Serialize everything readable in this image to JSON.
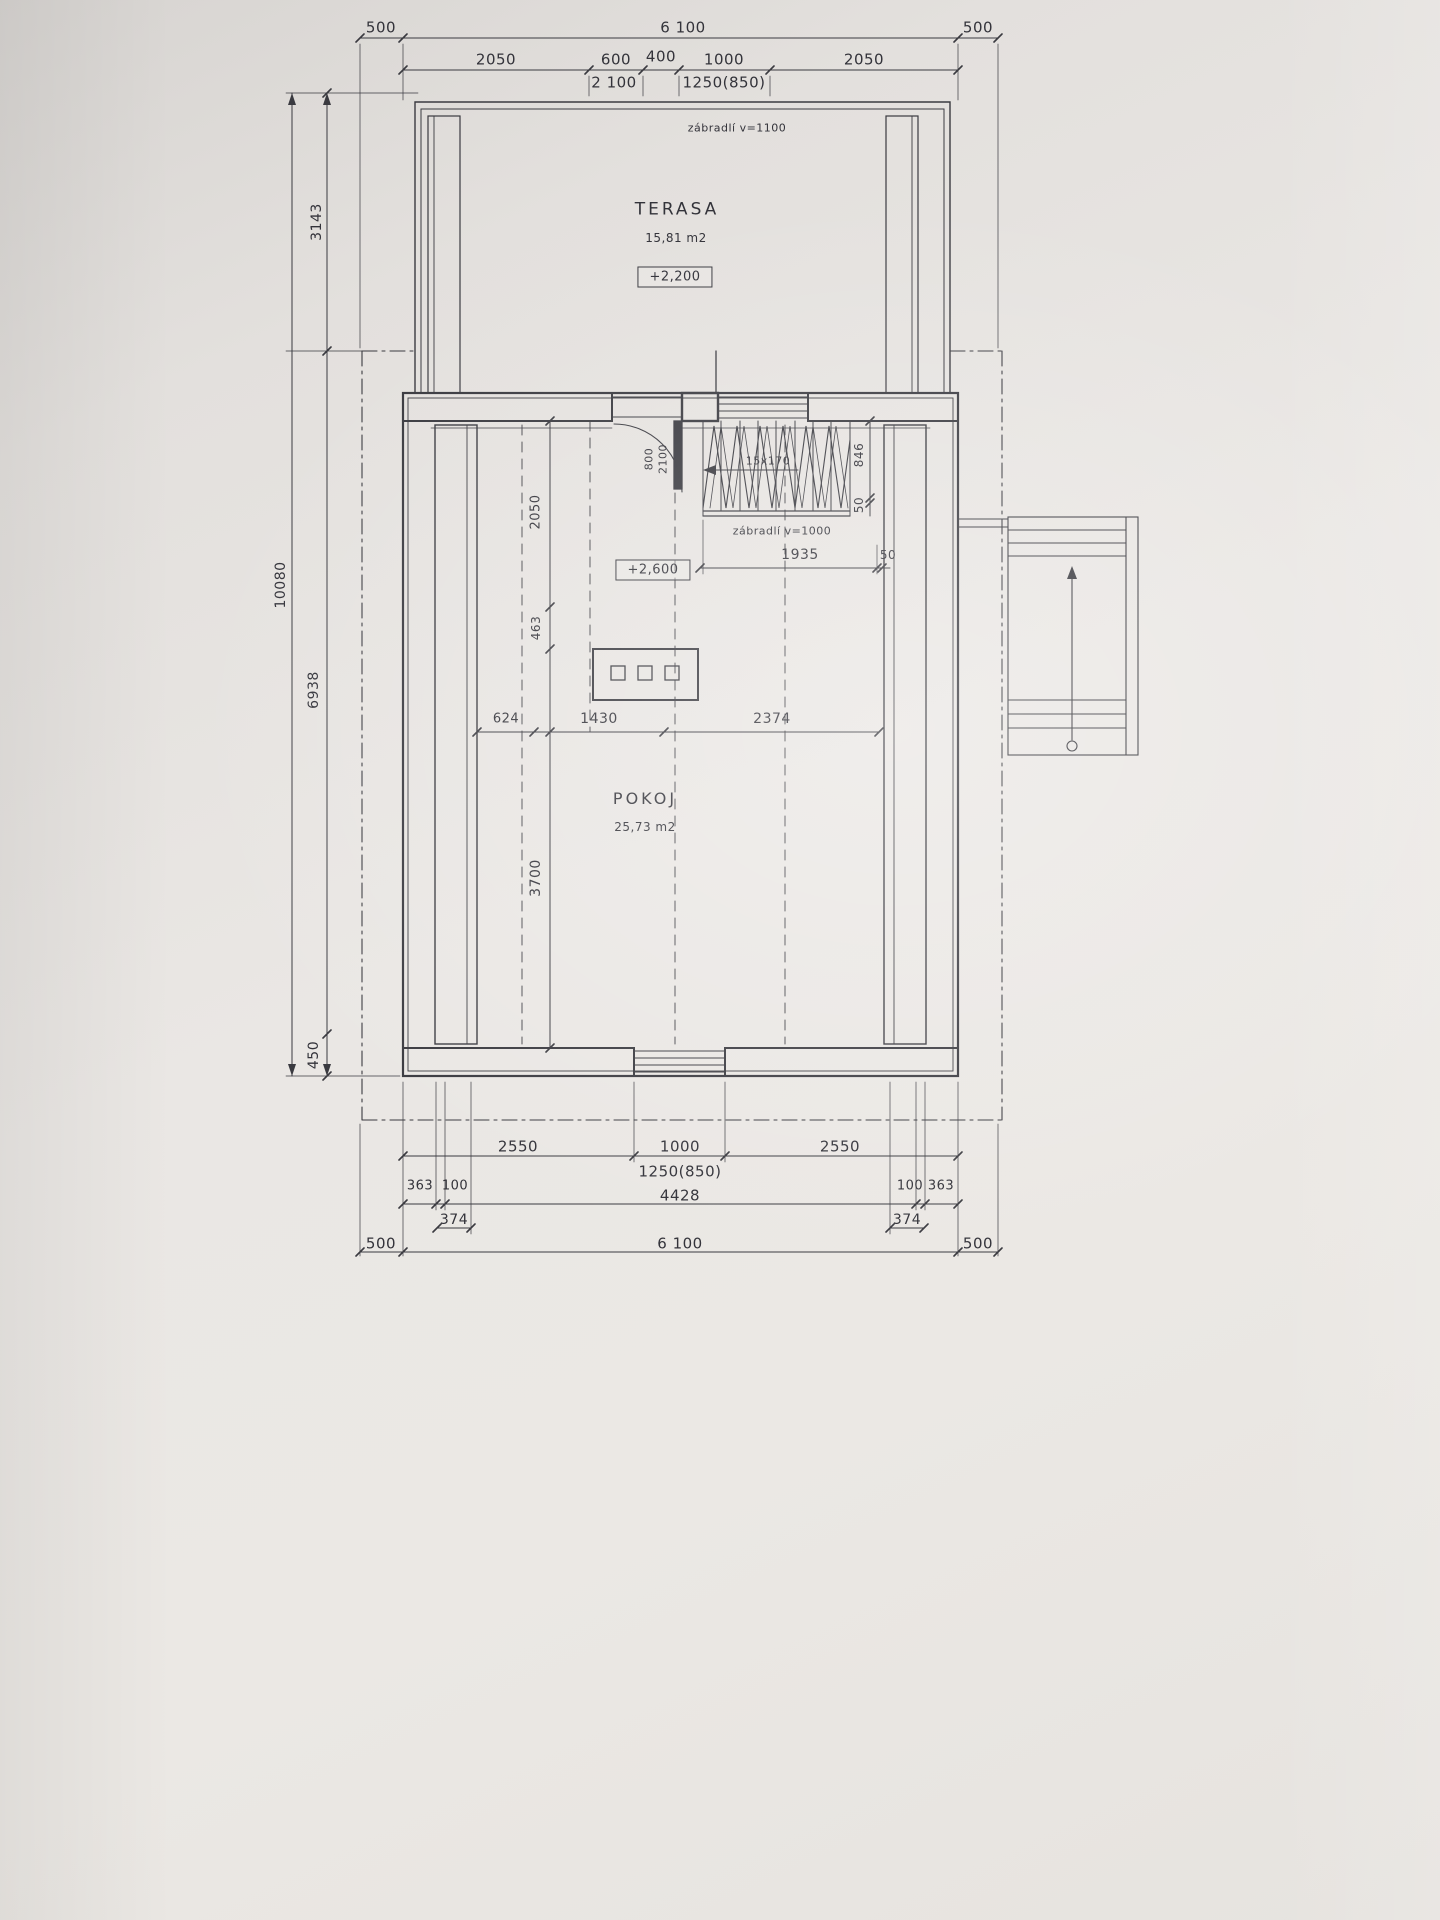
{
  "terrace": {
    "name": "TERASA",
    "area": "15,81 m2",
    "level": "+2,200",
    "railing": "zábradlí v=1100"
  },
  "room": {
    "name": "POKOJ",
    "area": "25,73 m2",
    "level": "+2,600"
  },
  "door": {
    "width": "800",
    "height": "2100"
  },
  "stairs": {
    "steps": "15x170",
    "railing": "zábradlí v=1000",
    "flight_width": "846",
    "gap": "50"
  },
  "dims": {
    "top": {
      "overhang_left": "500",
      "total": "6 100",
      "overhang_right": "500",
      "seg_2050_left": "2050",
      "seg_600": "600",
      "seg_400": "400",
      "seg_1000": "1000",
      "seg_2050_right": "2050",
      "door_height": "2 100",
      "window_spec": "1250(850)"
    },
    "left": {
      "terrace_depth": "3143",
      "total": "10080",
      "house_depth": "6938",
      "overhang": "450"
    },
    "interior": {
      "v_2050": "2050",
      "v_463": "463",
      "h_624": "624",
      "h_1430": "1430",
      "h_2374": "2374",
      "v_3700": "3700",
      "landing": "1935",
      "landing_gap": "50"
    },
    "bottom": {
      "seg_2550_left": "2550",
      "seg_1000": "1000",
      "seg_2550_right": "2550",
      "window_spec": "1250(850)",
      "off_363_left": "363",
      "off_100_left": "100",
      "span_4428": "4428",
      "off_100_right": "100",
      "off_363_right": "363",
      "off_374_left": "374",
      "off_374_right": "374",
      "overhang_left": "500",
      "total": "6 100",
      "overhang_right": "500"
    }
  },
  "colors": {
    "paper": "#e9e6e2",
    "ink": "#3a3a40"
  }
}
